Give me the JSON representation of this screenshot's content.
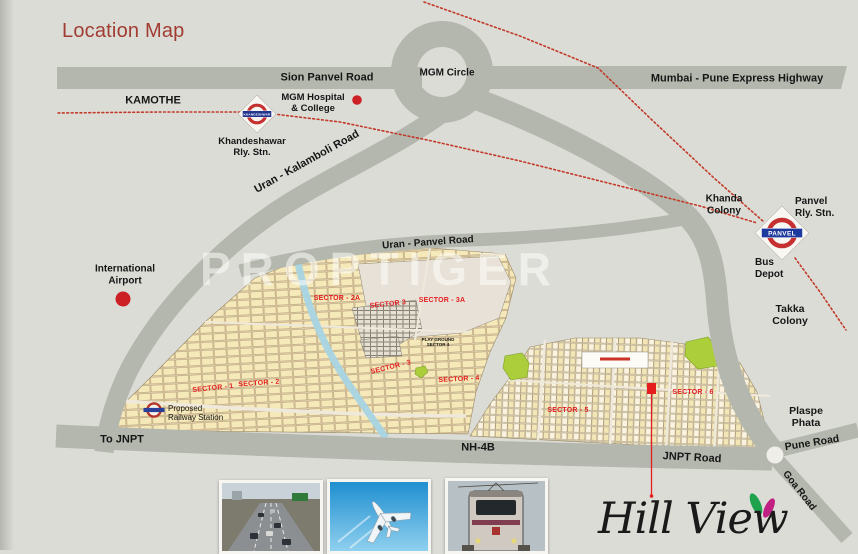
{
  "title": "Location Map",
  "watermark": "PROPTIGER",
  "brand": {
    "name": "Hill View"
  },
  "roads": {
    "sion_panvel": "Sion Panvel Road",
    "mgm_circle": "MGM Circle",
    "mumbai_pune_express": "Mumbai - Pune Express Highway",
    "uran_kalamboli": "Uran - Kalamboli Road",
    "uran_panvel": "Uran - Panvel Road",
    "to_jnpt": "To JNPT",
    "nh4b": "NH-4B",
    "jnpt_road": "JNPT Road",
    "pune_road": "Pune Road",
    "goa_road": "Goa Road"
  },
  "places": {
    "kamothe": "KAMOTHE",
    "mgm_hospital": {
      "line1": "MGM Hospital",
      "line2": "& College"
    },
    "khanda_colony": {
      "line1": "Khanda",
      "line2": "Colony"
    },
    "bus_depot": {
      "line1": "Bus",
      "line2": "Depot"
    },
    "takka_colony": {
      "line1": "Takka",
      "line2": "Colony"
    },
    "international_airport": {
      "line1": "International",
      "line2": "Airport"
    },
    "plaspe_phata": {
      "line1": "Plaspe",
      "line2": "Phata"
    }
  },
  "stations": {
    "khandeshawar": {
      "line1": "Khandeshawar",
      "line2": "Rly. Stn.",
      "logo": "KHANDESHWAR"
    },
    "panvel": {
      "line1": "Panvel",
      "line2": "Rly. Stn.",
      "logo": "PANVEL"
    },
    "proposed": {
      "line1": "Proposed",
      "line2": "Railway Station"
    }
  },
  "sectors": [
    "SECTOR - 2A",
    "SECTOR 3",
    "SECTOR - 3A",
    "SECTOR - 1",
    "SECTOR - 2",
    "SECTOR - 3",
    "SECTOR - 4",
    "SECTOR - 5",
    "SECTOR - 6"
  ],
  "play_ground": {
    "line1": "PLAY GROUND",
    "line2": "SECTOR 4"
  },
  "photos": [
    "expressway-traffic",
    "airplane",
    "local-train"
  ],
  "colors": {
    "background": "#dcdcd7",
    "road_gray": "#b4b7ae",
    "title_red": "#a13c33",
    "sector_red": "#e41f1f",
    "railway_dotted_red": "#c23a28",
    "plot_yellow": "#f5e9ba",
    "plot_cream": "#faf3df",
    "park_green": "#abce3a",
    "stream_blue": "#a8d4e4",
    "roundel_red": "#c53030",
    "roundel_navy": "#23368f",
    "logo_petal_green": "#1ea24c",
    "logo_petal_magenta": "#c02082"
  }
}
